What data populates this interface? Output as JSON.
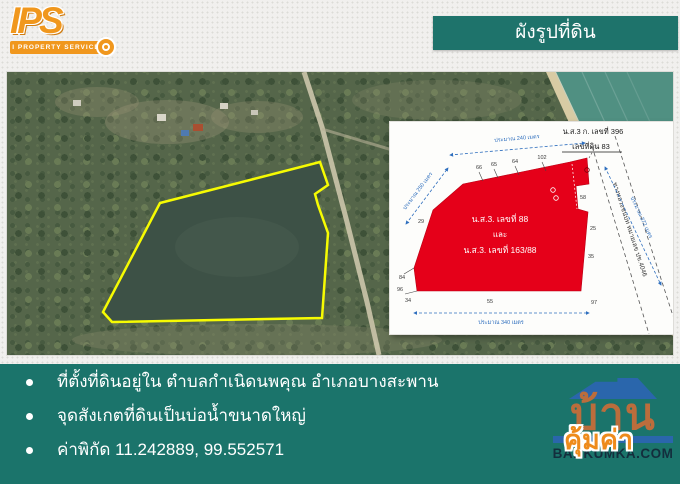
{
  "branding": {
    "logo_text": "IPS",
    "logo_subtitle": "I PROPERTY SERVICE"
  },
  "header": {
    "title": "ผังรูปที่ดิน"
  },
  "map": {
    "plot_outline_color": "#f6fb02",
    "description": "aerial-photo-with-plot-outline"
  },
  "diagram": {
    "deed_title": "น.ส.3 ก. เลขที่ 396",
    "deed_subtitle": "เลขที่ดิน 83",
    "plot_line1": "น.ส.3. เลขที่ 88",
    "plot_line2": "และ",
    "plot_line3": "น.ส.3. เลขที่ 163/88",
    "road_label": "ทางหลวงชนบท หมายเลข ปข.4046",
    "measure_top": "ประมาณ 240 เมตร",
    "measure_left": "ประมาณ 250 เมตร",
    "measure_bottom": "ประมาณ 340 เมตร",
    "measure_road": "ประมาณ 372 เมตร",
    "edge_numbers": [
      "66",
      "65",
      "64",
      "102",
      "29",
      "84",
      "96",
      "34",
      "55",
      "97",
      "58",
      "25",
      "35"
    ],
    "plot_color": "#e50019",
    "measure_color": "#2f6fbe"
  },
  "details": {
    "bullets": [
      "ที่ตั้งที่ดินอยู่ใน ตำบลกำเนิดนพคุณ อำเภอบางสะพาน",
      "จุดสังเกตที่ดินเป็นบ่อน้ำขนาดใหญ่",
      "ค่าพิกัด 11.242889, 99.552571"
    ]
  },
  "footer_logo": {
    "brand_text": "บ้าน",
    "brand_overlay": "คุ้มค่า",
    "website": "BANKUMKA.COM"
  },
  "colors": {
    "teal": "#1b746b",
    "orange": "#f0971d",
    "plot_red": "#e50019",
    "outline_yellow": "#f6fb02",
    "diagram_blue": "#2f6fbe"
  }
}
